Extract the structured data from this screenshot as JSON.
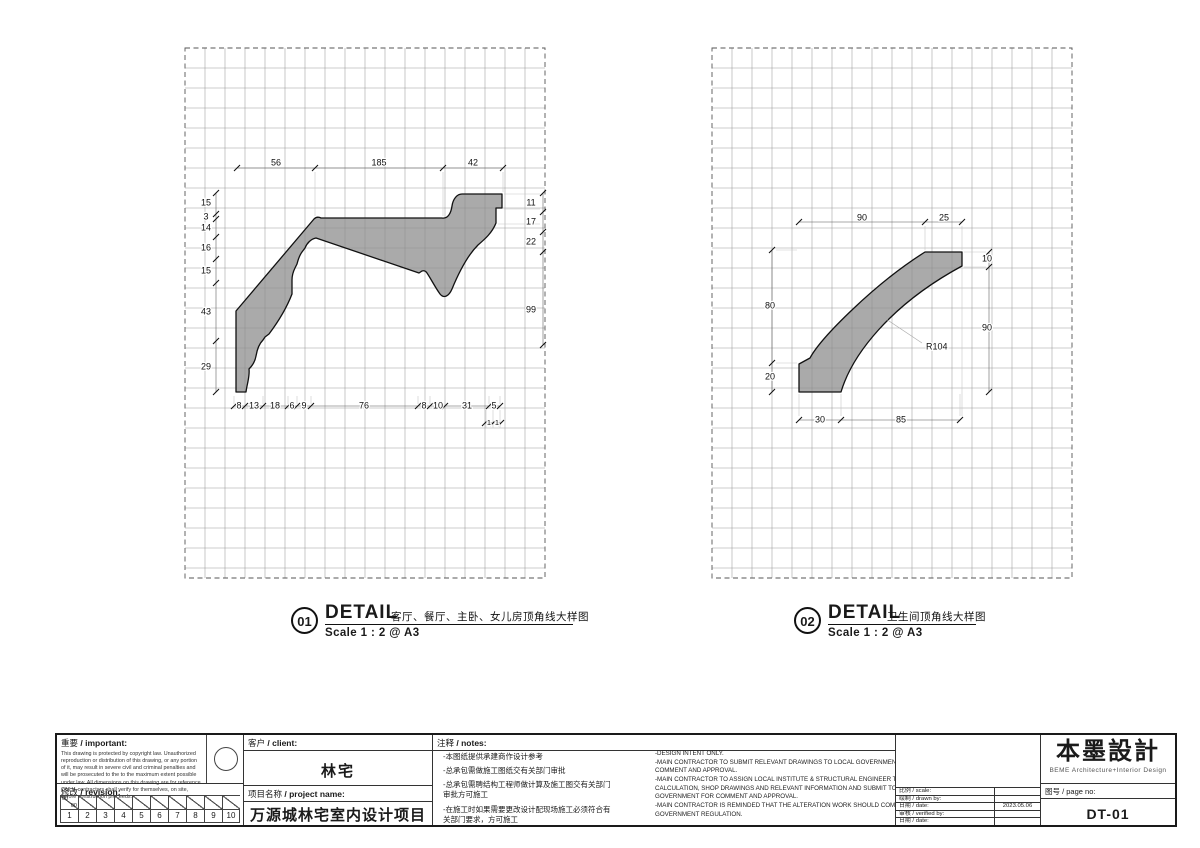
{
  "details": [
    {
      "number": "01",
      "title": "DETAIL",
      "caption": "客厅、餐厅、主卧、女儿房顶角线大样图",
      "scale": "Scale 1 : 2 @ A3",
      "dims": {
        "top": [
          "56",
          "185",
          "42"
        ],
        "left": [
          "15",
          "3",
          "14",
          "16",
          "15",
          "43",
          "29"
        ],
        "right": [
          "11",
          "17",
          "22",
          "99"
        ],
        "bottom": [
          "8",
          "13",
          "18",
          "6",
          "9",
          "76",
          "8",
          "10",
          "31",
          "5"
        ],
        "bottom2": [
          "1",
          "1"
        ]
      }
    },
    {
      "number": "02",
      "title": "DETAIL",
      "caption": "卫生间顶角线大样图",
      "scale": "Scale 1 : 2 @ A3",
      "dims": {
        "top": [
          "90",
          "25"
        ],
        "left": [
          "80",
          "20"
        ],
        "right": [
          "10",
          "90"
        ],
        "bottom": [
          "30",
          "85"
        ],
        "radius": [
          "R104"
        ]
      }
    }
  ],
  "titleblock": {
    "important": {
      "zh": "重要",
      "en": "/ important:",
      "body": "This drawing is protected by copyright law. Unauthorized reproduction or distribution of this drawing, or any portion of it, may result in severe civil and criminal penalties and will be prosecuted to the to the maximum extent possible under law. All dimensions on this drawing are for reference ONLY, contractors shall verify for themselves, on site, before construction proceeds."
    },
    "revision": {
      "zh": "修改",
      "en": "/ revision:",
      "first_top": "00",
      "first_bottom": "00",
      "numbers": [
        "1",
        "2",
        "3",
        "4",
        "5",
        "6",
        "7",
        "8",
        "9",
        "10"
      ]
    },
    "client": {
      "zh": "客户",
      "en": "/ client:",
      "value": "林宅"
    },
    "project": {
      "zh": "项目名称",
      "en": "/ project name:",
      "value": "万源城林宅室内设计项目"
    },
    "notes": {
      "zh_label": "注释",
      "en_label": "/ notes:",
      "zh": [
        "-本图纸提供承建商作设计参考",
        "-总承包需做施工图纸交有关部门审批",
        "-总承包需聘结构工程师做计算及施工图交有关部门审批方可施工",
        "-在施工时如果需要更改设计配现场施工必须符合有关部门要求，方可施工"
      ],
      "en": [
        "-DESIGN INTENT ONLY.",
        "-MAIN CONTRACTOR TO SUBMIT RELEVANT DRAWINGS TO LOCAL GOVERNMENT FOR COMMENT AND APPROVAL.",
        "-MAIN CONTRACTOR TO ASSIGN LOCAL INSTITUTE & STRUCTURAL ENGINEER TO PREPARE CALCULATION, SHOP DRAWINGS AND RELEVANT INFORMATION AND SUBMIT TO LOCAL GOVERNMENT FOR COMMENT AND APPROVAL.",
        "-MAIN CONTRACTOR IS REMINDED THAT THE ALTERATION WORK SHOULD COMPLY WITH LOCAL GOVERNMENT REGULATION."
      ]
    },
    "fields": [
      {
        "label": "比例 / scale:",
        "value": ""
      },
      {
        "label": "绘制 / drawn by:",
        "value": ""
      },
      {
        "label": "日期 / date:",
        "value": "2023.05.06"
      },
      {
        "label": "审核 / verified by:",
        "value": ""
      },
      {
        "label": "日期 / date:",
        "value": ""
      }
    ],
    "logo": {
      "name": "本墨設計",
      "subtitle": "BEME  Architecture+Interior  Design"
    },
    "pageno": {
      "label": "图号 / page no:",
      "value": "DT-01"
    }
  },
  "colors": {
    "molding_fill": "#8d8d8d",
    "grid_line": "#9a9a9a",
    "border_dash": "#555555",
    "dim_line": "#555555",
    "ink": "#111111",
    "witness": "#c7c7c7"
  }
}
